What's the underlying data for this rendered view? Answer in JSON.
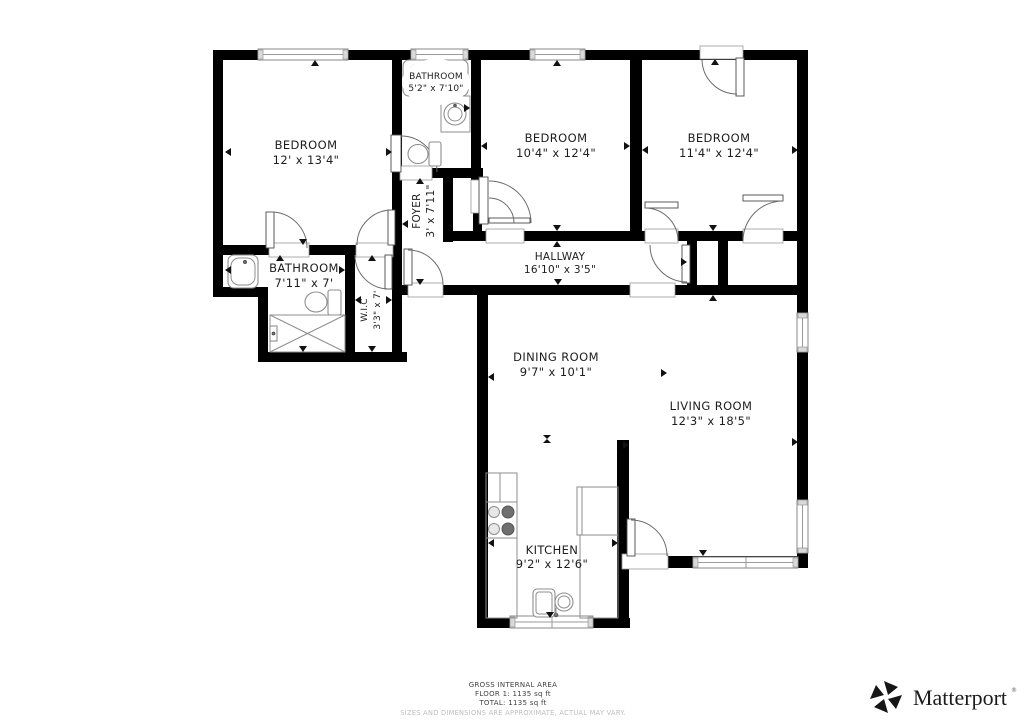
{
  "plan": {
    "rooms": [
      {
        "id": "bedroom-1",
        "name": "BEDROOM",
        "dims": "12' x 13'4\""
      },
      {
        "id": "bathroom-top",
        "name": "BATHROOM",
        "dims": "5'2\" x 7'10\""
      },
      {
        "id": "bedroom-2",
        "name": "BEDROOM",
        "dims": "10'4\" x 12'4\""
      },
      {
        "id": "bedroom-3",
        "name": "BEDROOM",
        "dims": "11'4\" x 12'4\""
      },
      {
        "id": "foyer",
        "name": "FOYER",
        "dims": "3' x 7'11\""
      },
      {
        "id": "hallway",
        "name": "HALLWAY",
        "dims": "16'10\" x 3'5\""
      },
      {
        "id": "bathroom-main",
        "name": "BATHROOM",
        "dims": "7'11\" x 7'"
      },
      {
        "id": "walk-in-closet",
        "name": "W.I.C",
        "dims": "3'3\" x 7'"
      },
      {
        "id": "dining-room",
        "name": "DINING ROOM",
        "dims": "9'7\" x 10'1\""
      },
      {
        "id": "living-room",
        "name": "LIVING ROOM",
        "dims": "12'3\" x 18'5\""
      },
      {
        "id": "kitchen",
        "name": "KITCHEN",
        "dims": "9'2\" x 12'6\""
      }
    ]
  },
  "footer": {
    "area_title": "GROSS INTERNAL AREA",
    "floor_line": "FLOOR 1: 1135 sq ft",
    "total_line": "TOTAL: 1135 sq ft",
    "disclaimer": "SIZES AND DIMENSIONS ARE APPROXIMATE, ACTUAL MAY VARY."
  },
  "branding": {
    "logo_text": "Matterport",
    "trademark": "®"
  },
  "colors": {
    "wall": "#000000",
    "floor": "#ffffff",
    "fixture_outline": "#8e8e8e",
    "door_line": "#6b6b6b",
    "marker": "#111111",
    "label_text": "#1d1d1d",
    "disclaimer_text": "#bdbdbd",
    "logo": "#161616"
  }
}
